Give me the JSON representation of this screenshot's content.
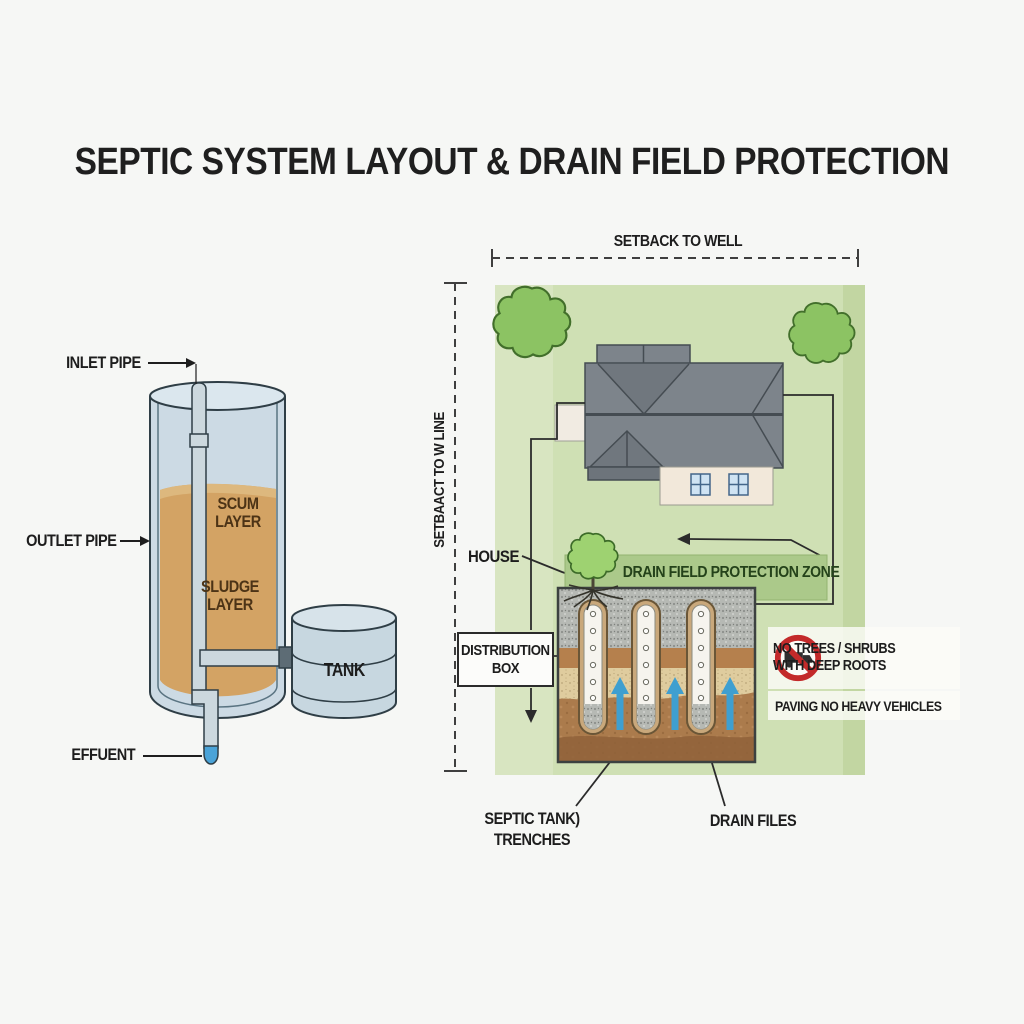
{
  "title": "SEPTIC SYSTEM LAYOUT & DRAIN FIELD PROTECTION",
  "septic_tank": {
    "inlet_pipe": "INLET PIPE",
    "outlet_pipe": "OUTLET PIPE",
    "scum_layer": [
      "SCUM",
      "LAYER"
    ],
    "sludge_layer": [
      "SLUDGE",
      "LAYER"
    ],
    "pump_tank": "TANK",
    "effluent": "EFFUENT"
  },
  "site_plan": {
    "setback_to_well": "SETBACK TO WELL",
    "setback_to_line": "SETBAACT TO W LINE",
    "house": "HOUSE",
    "protection_zone": "DRAIN FIELD PROTECTION ZONE",
    "distribution_box": [
      "DISTRIBUTION",
      "BOX"
    ],
    "no_trees": [
      "NO TREES / SHRUBS",
      "WITH DEEP ROOTS"
    ],
    "paving": "PAVING NO HEAVY VEHICLES",
    "septic_trenches": [
      "SEPTIC TANK)",
      "TRENCHES"
    ],
    "drain_tiles": "DRAIN FILES"
  },
  "colors": {
    "background": "#f6f7f5",
    "plot_green": "#cfe0b4",
    "zone_green": "#abc98a",
    "zone_text": "#24421a",
    "tank_wall": "#ccdae4",
    "tank_outline": "#2f3e46",
    "liquid_tan": "#d3a364",
    "effluent_blue": "#4aa3d8",
    "roof_gray": "#7d848b",
    "tree_green": "#8cc363",
    "soil_brown": "#ab7b4c",
    "gravel_gray": "#b6b9b4",
    "sand_tan": "#dfcc9e",
    "arrow_blue": "#3f9fd0",
    "prohibition_red": "#c32a2a"
  }
}
